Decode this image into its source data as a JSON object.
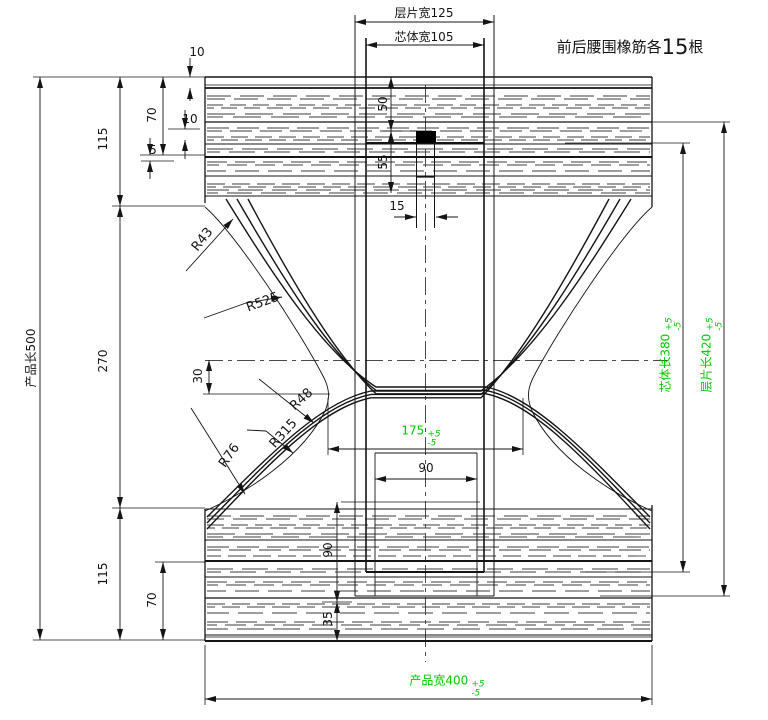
{
  "note": {
    "prefix": "前后腰围橡筋各",
    "count": "15",
    "suffix": "根"
  },
  "dims": {
    "layer_width": {
      "label": "层片宽125"
    },
    "core_width": {
      "label": "芯体宽105"
    },
    "product_length": {
      "label": "产品长500"
    },
    "left_top_115": "115",
    "left_mid_270": "270",
    "left_bot_115": "115",
    "waist_top_70": "70",
    "waist_bot_70": "70",
    "gap_10a": "10",
    "gap_10b": "10",
    "gap_5": "5",
    "center_50": "50",
    "center_55": "55",
    "tape_15": "15",
    "crotch_offset_30": "30",
    "inner_90_h": "90",
    "inner_90_v": "90",
    "inner_35": "35",
    "crotch_width": {
      "value": "175",
      "tol_plus": "+5",
      "tol_minus": "-5"
    },
    "core_length": {
      "label": "芯体长380",
      "tol_plus": "+5",
      "tol_minus": "-5"
    },
    "layer_length": {
      "label": "层片长420",
      "tol_plus": "+5",
      "tol_minus": "-5"
    },
    "product_width": {
      "label": "产品宽400",
      "tol_plus": "+5",
      "tol_minus": "-5"
    }
  },
  "radii": {
    "r43": "R43",
    "r525": "R525",
    "r48": "R48",
    "r315": "R315",
    "r76": "R76"
  },
  "colors": {
    "line": "#141414",
    "elastic": "#3d3d3d",
    "green": "#00c800"
  }
}
